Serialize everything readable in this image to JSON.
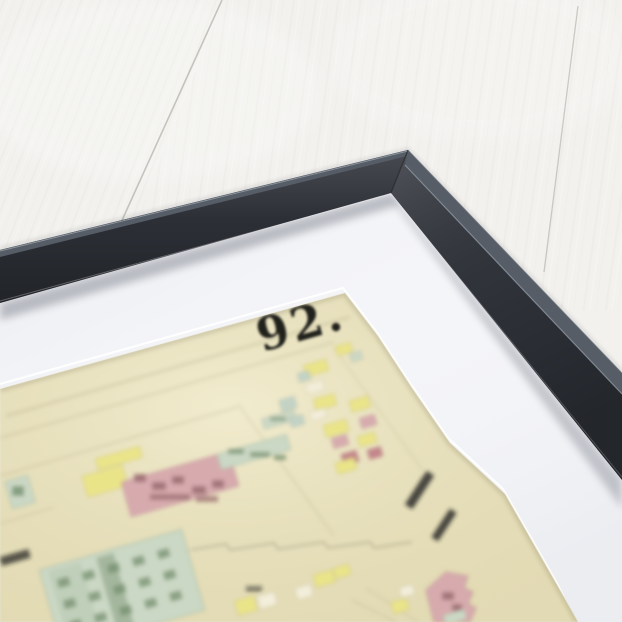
{
  "artwork": {
    "plate_number": "92."
  },
  "palette": {
    "wood_base": "#f2f1ee",
    "wood_grain_light": "#faf9f7",
    "wood_grain_dark": "#e2dfda",
    "wood_seam": "#b9b6af",
    "frame_face": "#32363d",
    "frame_top": "#565d67",
    "frame_highlight": "#9aa2ad",
    "mat": "#f4f5f8",
    "mat_shadow": "#c9ccd4",
    "paper": "#ece5c1",
    "paper_edge": "#8a8058",
    "ink": "#20201e",
    "ink_faint": "#a99f7b",
    "pink": "#d7abae",
    "pink_dark": "#b98b8e",
    "pink_ink": "#96666b",
    "red_block": "#c4868b",
    "yellow": "#eae489",
    "yellow_pale": "#f0ecc2",
    "green": "#cbd8c5",
    "green_dark": "#a4b89f",
    "green_ink": "#76906f",
    "teal": "#c2d3c6",
    "cell_white": "#f3eeda"
  }
}
